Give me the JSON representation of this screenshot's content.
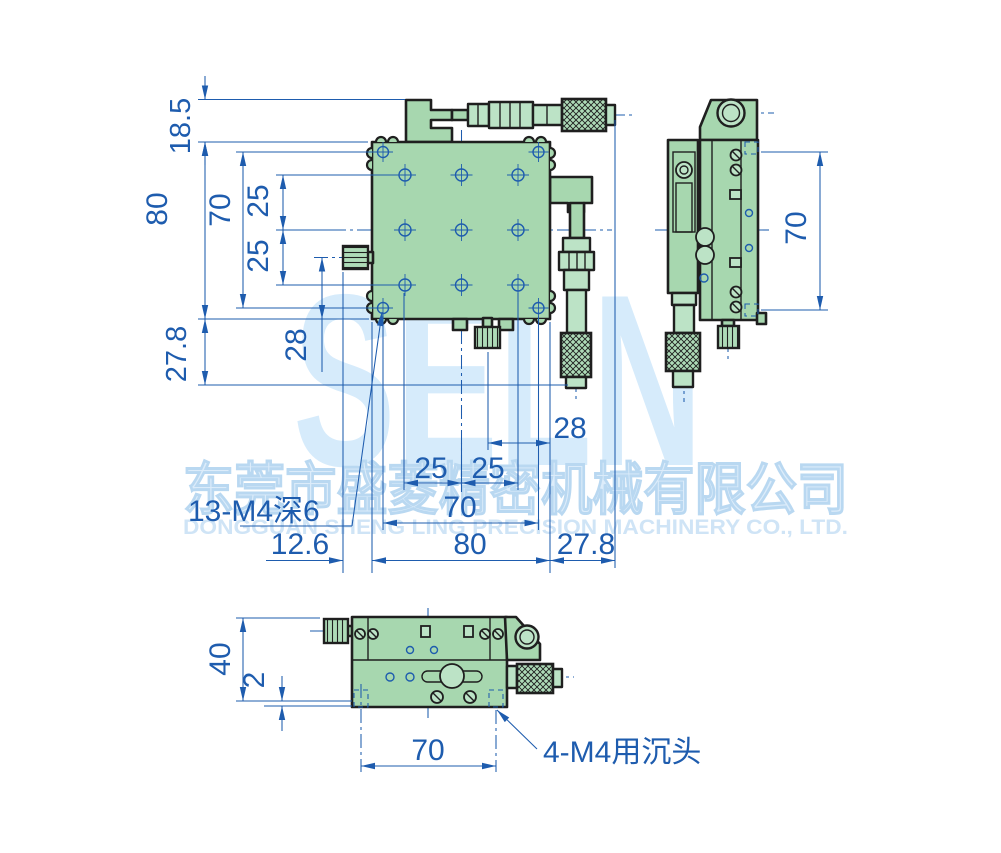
{
  "drawing": {
    "watermark": {
      "logo_text": "SELN",
      "company_cn": "东莞市盛菱精密机械有限公司",
      "company_en": "DONGGUAN SHENG LING PRECISION MACHINERY CO., LTD."
    },
    "colors": {
      "dimension_blue": "#1e5cae",
      "body_green": "#a7d7af",
      "body_green_light": "#bce3c6",
      "outline_dark": "#1f1f1f",
      "watermark_blue": "#d6ebfb"
    },
    "front_view": {
      "dim_18_5": "18.5",
      "dim_80_v": "80",
      "dim_70_v": "70",
      "dim_25_v1": "25",
      "dim_25_v2": "25",
      "dim_27_8_v": "27.8",
      "dim_28_v": "28",
      "dim_28_h": "28",
      "dim_25_h1": "25",
      "dim_25_h2": "25",
      "dim_70_h": "70",
      "dim_80_h": "80",
      "dim_27_8_h": "27.8",
      "dim_12_6_h": "12.6",
      "label_holes": "13-M4深6"
    },
    "side_view": {
      "dim_70_v": "70"
    },
    "bottom_view": {
      "dim_40": "40",
      "dim_2": "2",
      "dim_70": "70",
      "label_counterbore": "4-M4用沉头"
    }
  }
}
